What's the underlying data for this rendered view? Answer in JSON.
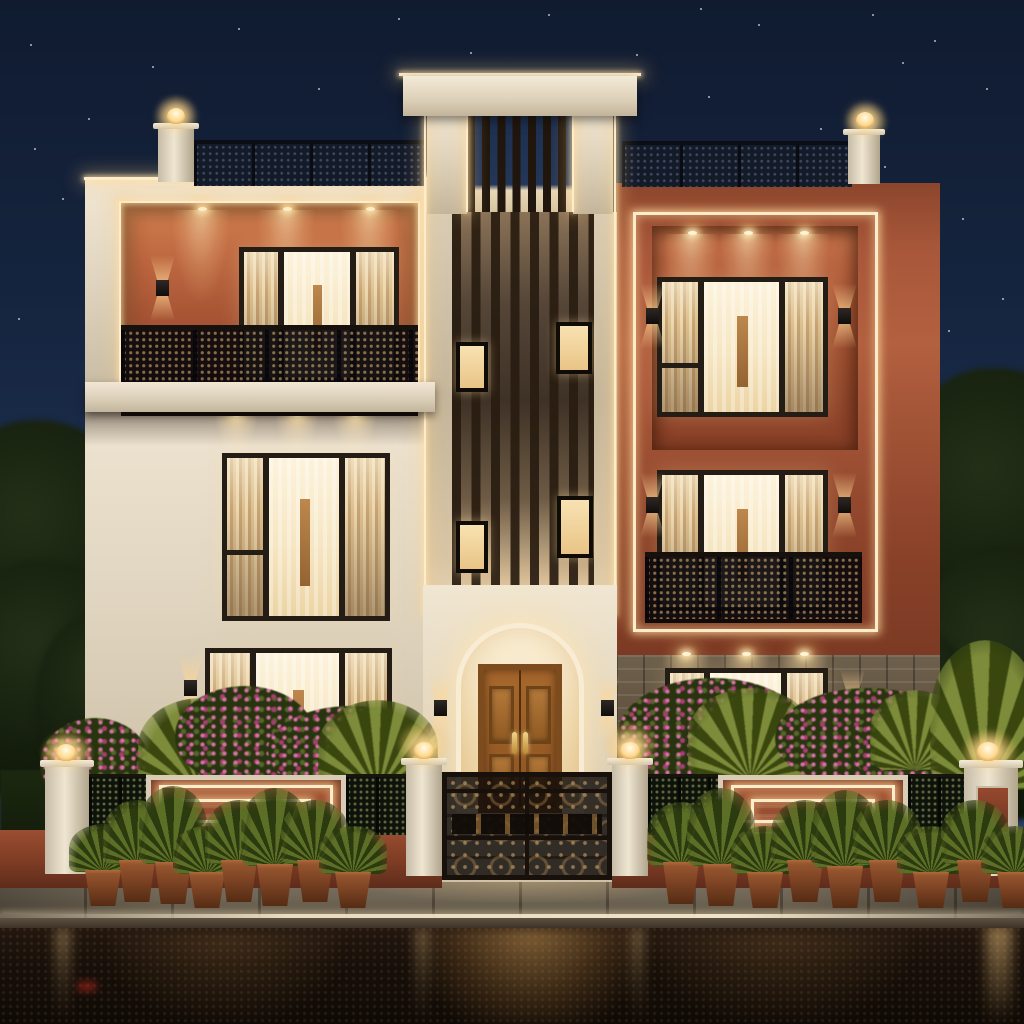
{
  "scene": {
    "title": "Night-time 3D architectural rendering of a modern three-storey duplex house in cream and terracotta",
    "time_of_day": "night",
    "weather": "wet street reflecting warm facade lights",
    "labels": {
      "scene": "Night exterior rendering of a modern three-storey house",
      "sky": "Deep blue night sky with scattered stars",
      "building": "Modern cream and terracotta duplex facade with LED cove lighting",
      "left_wing": "Cream left wing with terracotta top-floor balcony",
      "balcony": "Top-floor balcony with laser-cut black railing and recessed downlights",
      "tower": "Central tower with dark wooden vertical slat screen and small lit windows",
      "right_wing": "Terracotta right wing outlined with warm LED strip",
      "roof_railing": "Perforated black rooftop parapet railing",
      "entrance": "Arched warm-lit entrance portal",
      "door": "Carved wooden double entrance door with brass handles",
      "gate": "Black ornamental laser-cut entry gate",
      "boundary_wall": "Compound wall with LED-outlined terracotta panels and lattice screens",
      "pillar_lamp": "White gate pillar with glowing post lamp",
      "garden": "Bougainvillea shrubs and palm fronds behind the compound wall",
      "planters": "Row of leafy plants in terracotta pots along the sidewalk",
      "sidewalk": "Stone paved sidewalk with lit curb edge",
      "street": "Wet asphalt road with warm light reflections"
    },
    "counts": {
      "floors": 3,
      "roof_pillar_lamps": 2,
      "gate_pillar_lamps": 4,
      "tower_slat_windows": 4,
      "planter_pots": 17,
      "balcony_downlights": 3,
      "right_wing_downlights": 3
    },
    "palette": {
      "sky_top": "#101b30",
      "sky_mid": "#1c2f4e",
      "sky_bottom": "#33496e",
      "star": "#d8e2f2",
      "cream": "#e9dfcd",
      "cream_dark": "#c9bca4",
      "cream_lit": "#f8edd6",
      "terracotta": "#a8573a",
      "terracotta_dark": "#7c3a24",
      "terracotta_lit": "#c97a4e",
      "led": "#ffeccb",
      "led_glow": "#ffd9a0",
      "frame": "#241d15",
      "glass_warm": "#f7e9cc",
      "curtain": "#e3cda6",
      "curtain_dark": "#c2a277",
      "wood": "#9a5f28",
      "wood_dark": "#6e4318",
      "brass": "#e2b763",
      "screen_dark": "#131a28",
      "rail_dark": "#120e14",
      "stone": "#6a5c48",
      "stone_dark": "#463a2c",
      "leaf": "#4a5a22",
      "leaf_dark": "#222e10",
      "flower": "#d873a8",
      "flower_deep": "#aa3b74",
      "pot": "#94552e",
      "pavement": "#6e6455",
      "road": "#150d08",
      "road_glow": "#8a6434"
    }
  }
}
